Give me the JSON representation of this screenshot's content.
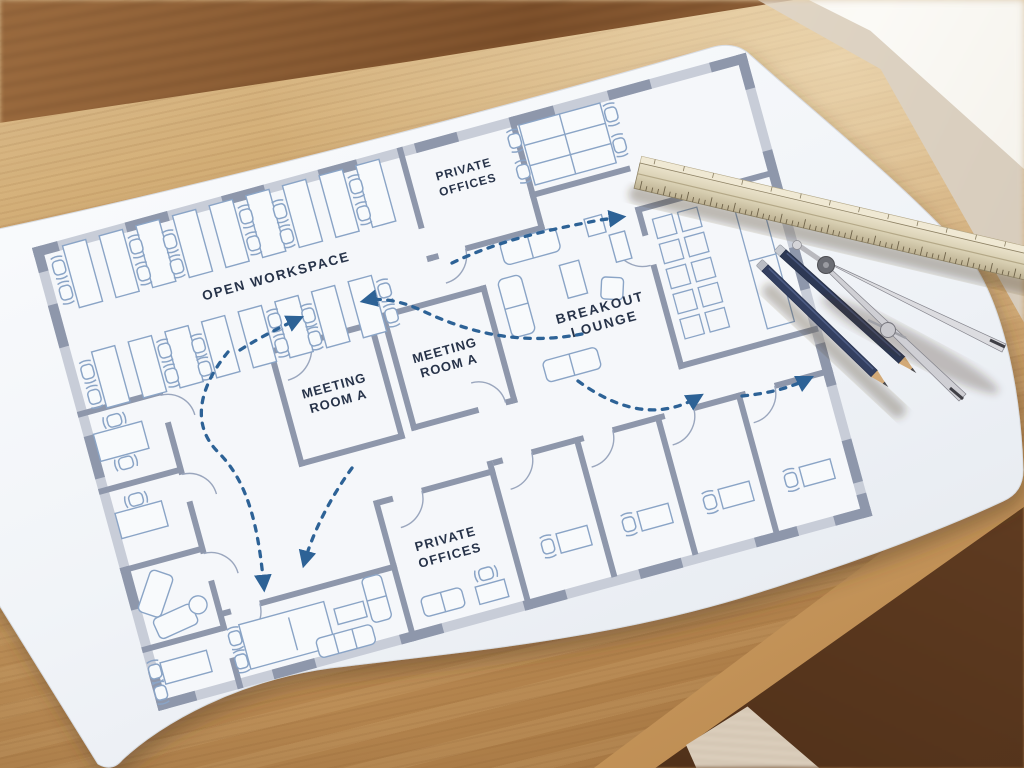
{
  "scene": {
    "subject": "office floor plan blueprint on wooden drafting desk",
    "colors": {
      "desk_oak": "#c69a60",
      "desk_oak_light": "#dcc094",
      "desk_panel_dark": "#7c4f2a",
      "under_desk": "#5d3a20",
      "wall_beige": "#d9cfc0",
      "window_light": "#fbfaf6",
      "paper": "#f3f5f8",
      "plan_wall": "#8e97ab",
      "plan_window_track": "#c8cdd8",
      "plan_furniture": "#8aa4c6",
      "label_ink": "#273349",
      "arrow_blue": "#2d6296"
    }
  },
  "floor_plan": {
    "labels": {
      "open_workspace": "OPEN WORKSPACE",
      "private_offices_top": {
        "line1": "PRIVATE",
        "line2": "OFFICES"
      },
      "breakout_lounge": {
        "line1": "BREAKOUT",
        "line2": "LOUNGE"
      },
      "meeting_room_left": {
        "line1": "MEETING",
        "line2": "ROOM A"
      },
      "meeting_room_right": {
        "line1": "MEETING",
        "line2": "ROOM A"
      },
      "private_offices_bottom": {
        "line1": "PRIVATE",
        "line2": "OFFICES"
      }
    },
    "annotations": {
      "circulation_arrows": "dashed blue flow arrows through corridors"
    }
  },
  "tools": {
    "ruler": "triangular-scale-ruler",
    "compass": "drafting-compass",
    "pencils": [
      "pencil",
      "pencil"
    ]
  }
}
